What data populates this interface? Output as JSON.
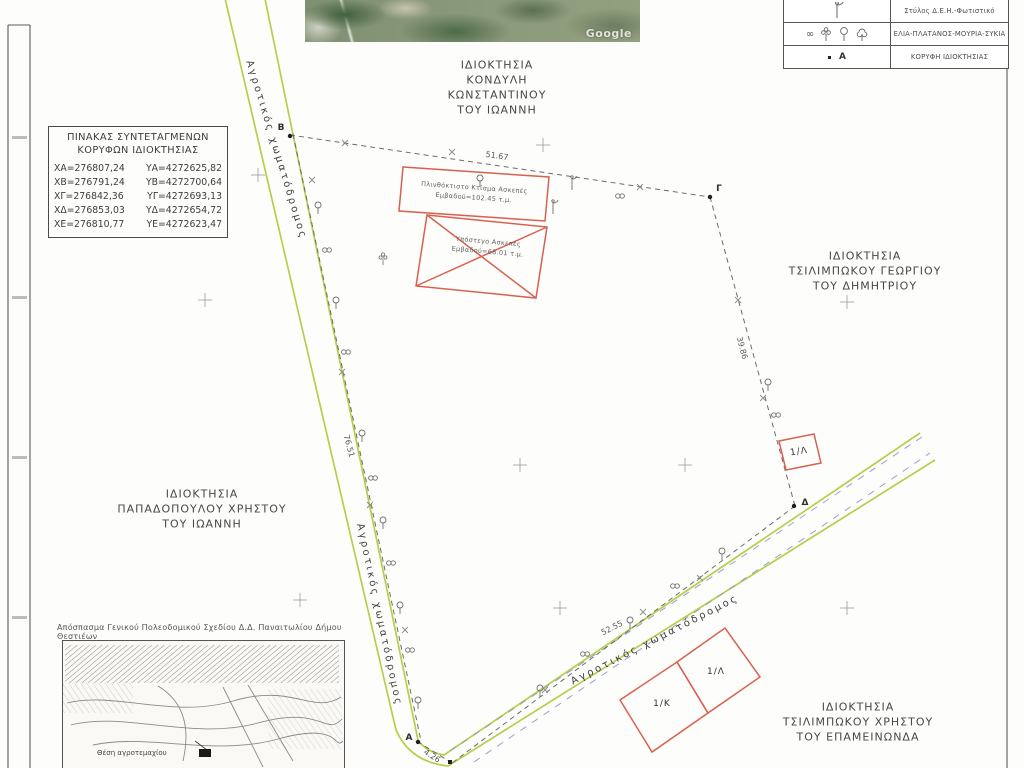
{
  "coords_table": {
    "title": "ΠΙΝΑΚΑΣ ΣΥΝΤΕΤΑΓΜΕΝΩΝ\nΚΟΡΥΦΩΝ ΙΔΙΟΚΤΗΣΙΑΣ",
    "rows": [
      {
        "x": "ΧΑ=276807,24",
        "y": "ΥΑ=4272625,82"
      },
      {
        "x": "ΧΒ=276791,24",
        "y": "ΥΒ=4272700,64"
      },
      {
        "x": "ΧΓ=276842,36",
        "y": "ΥΓ=4272693,13"
      },
      {
        "x": "ΧΔ=276853,03",
        "y": "ΥΔ=4272654,72"
      },
      {
        "x": "ΧΕ=276810,77",
        "y": "ΥΕ=4272623,47"
      }
    ]
  },
  "legend": {
    "rows": [
      {
        "label": "Στύλος Δ.Ε.Η.-Φωτιστικό",
        "symbol": ""
      },
      {
        "label": "ΕΛΙΑ-ΠΛΑΤΑΝΟΣ-ΜΟΥΡΙΑ-ΣΥΚΙΑ",
        "symbol": "∞"
      },
      {
        "label": "ΚΟΡΥΦΗ ΙΔΙΟΚΤΗΣΙΑΣ",
        "symbol": "Α"
      }
    ]
  },
  "properties": {
    "north": "ΙΔΙΟΚΤΗΣΙΑ\nΚΟΝΔΥΛΗ\nΚΩΝΣΤΑΝΤΙΝΟΥ\nΤΟΥ ΙΩΑΝΝΗ",
    "east": "ΙΔΙΟΚΤΗΣΙΑ\nΤΣΙΛΙΜΠΩΚΟΥ ΓΕΩΡΓΙΟΥ\nΤΟΥ ΔΗΜΗΤΡΙΟΥ",
    "west": "ΙΔΙΟΚΤΗΣΙΑ\nΠΑΠΑΔΟΠΟΥΛΟΥ ΧΡΗΣΤΟΥ\nΤΟΥ ΙΩΑΝΝΗ",
    "southeast": "ΙΔΙΟΚΤΗΣΙΑ\nΤΣΙΛΙΜΠΩΚΟΥ ΧΡΗΣΤΟΥ\nΤΟΥ ΕΠΑΜΕΙΝΩΝΔΑ"
  },
  "buildings": {
    "b1": "Πλινθόκτιστο Κτίσμα Ασκεπές\nΕμβαδού=102.45 τ.μ.",
    "b2": "Υπόστεγο Ασκεπές\nΕμβαδού=68.01 τ.μ."
  },
  "roads": {
    "label": "Αγροτικός χωματόδρομος"
  },
  "dimensions": {
    "ab": "76.51",
    "bg": "51.67",
    "gd": "39.86",
    "de": "52.55",
    "ea": "4.26"
  },
  "vertices": {
    "a": "Α",
    "b": "Β",
    "g": "Γ",
    "d": "Δ"
  },
  "parcels": {
    "k": "1/Κ",
    "l": "1/Λ"
  },
  "inset": {
    "caption": "Απόσπασμα Γενικού Πολεοδομικού Σχεδίου Δ.Δ. Παναιτωλίου Δήμου Θεστιέων",
    "location_label": "Θέση αγροτεμαχίου"
  },
  "satellite": {
    "watermark": "Google"
  }
}
